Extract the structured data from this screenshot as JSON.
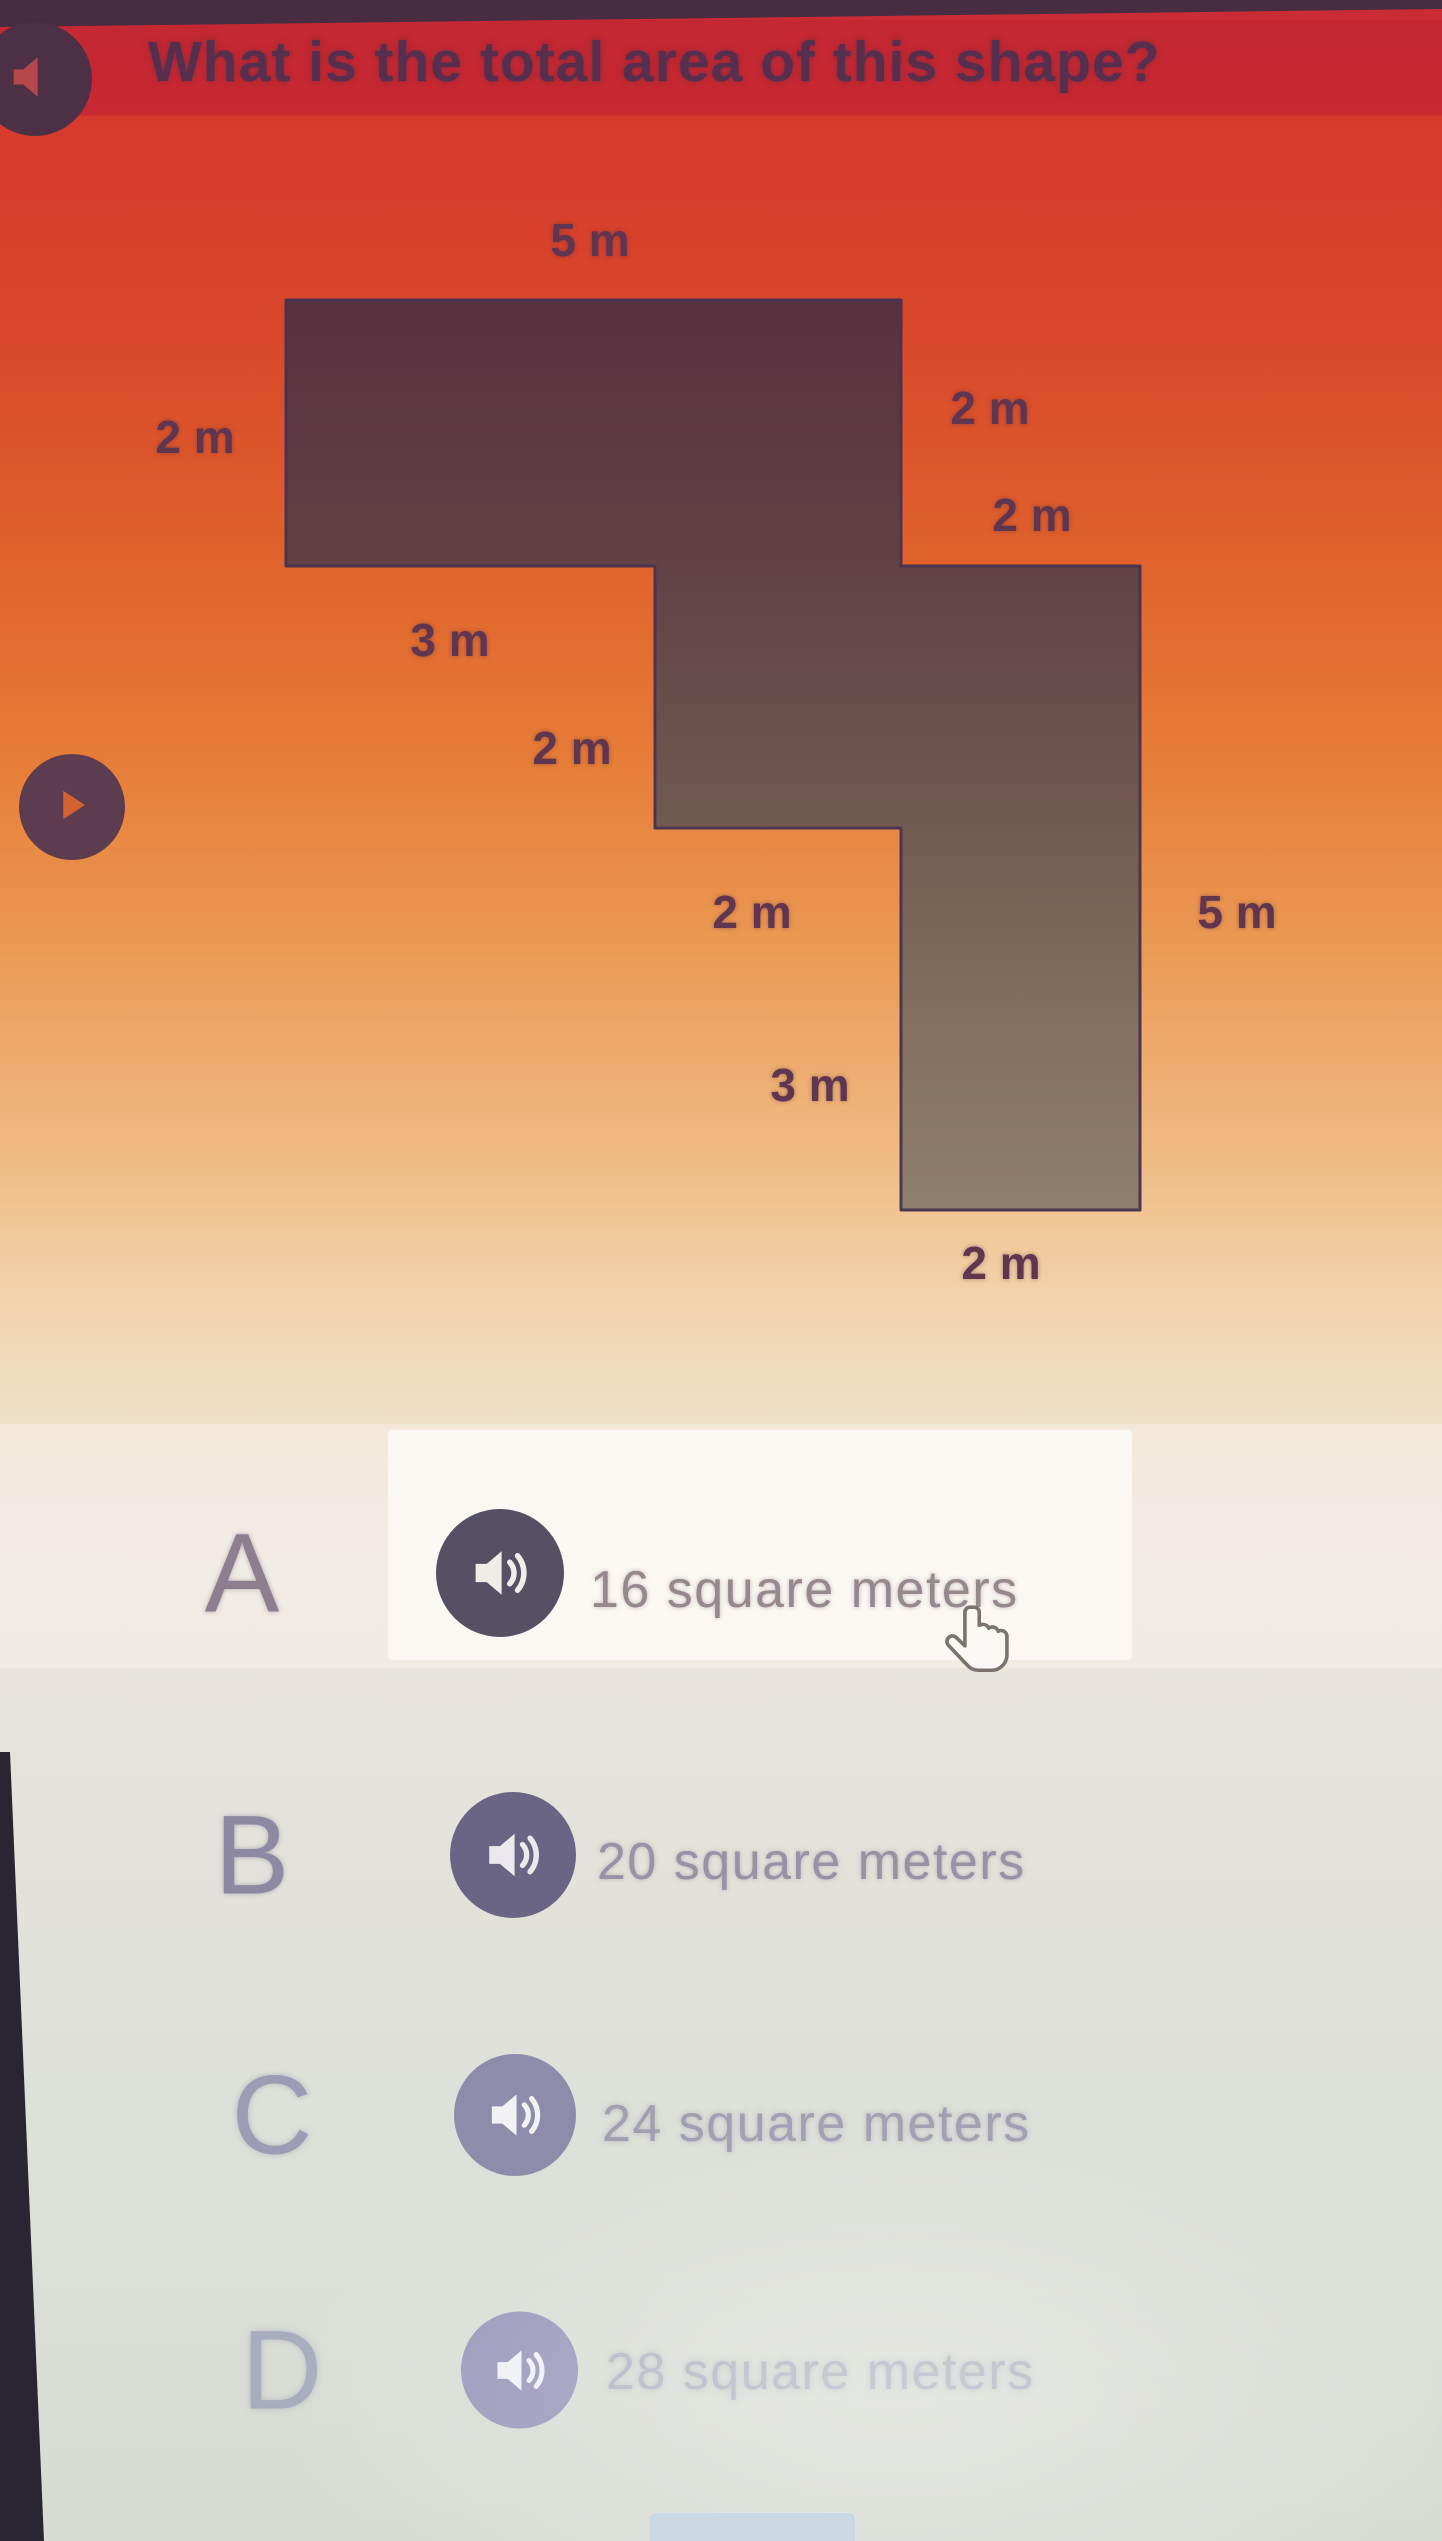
{
  "question": {
    "text": "What is the total area of this shape?"
  },
  "figure": {
    "description": "composite rectilinear staircase shape with labeled side lengths",
    "unit": "m",
    "dimension_labels": [
      {
        "side": "top",
        "text": "5 m"
      },
      {
        "side": "upper-left",
        "text": "2 m"
      },
      {
        "side": "upper-right",
        "text": "2 m"
      },
      {
        "side": "right-step",
        "text": "2 m"
      },
      {
        "side": "upper-bottom-edge",
        "text": "3 m"
      },
      {
        "side": "middle-left",
        "text": "2 m"
      },
      {
        "side": "middle-step",
        "text": "2 m"
      },
      {
        "side": "right",
        "text": "5 m"
      },
      {
        "side": "lower-left",
        "text": "3 m"
      },
      {
        "side": "bottom",
        "text": "2 m"
      }
    ]
  },
  "answers": [
    {
      "letter": "A",
      "text": "16 square meters"
    },
    {
      "letter": "B",
      "text": "20 square meters"
    },
    {
      "letter": "C",
      "text": "24 square meters"
    },
    {
      "letter": "D",
      "text": "28 square meters"
    }
  ],
  "icons": {
    "question_speaker": "speaker-icon",
    "read_aloud": "play-icon",
    "answer_speaker": "speaker-waves-icon",
    "cursor": "hand-pointer-cursor"
  },
  "colors": {
    "question_band": "#c92b34",
    "question_text": "#572f4e",
    "shape_fill_top": "#54313e",
    "shape_fill_bottom": "#8d7d6c",
    "shape_outline": "#463350",
    "answer_circle_dark": "#565064",
    "answer_circle_light": "#9a98bb",
    "answer_letter": "#908a9c"
  }
}
